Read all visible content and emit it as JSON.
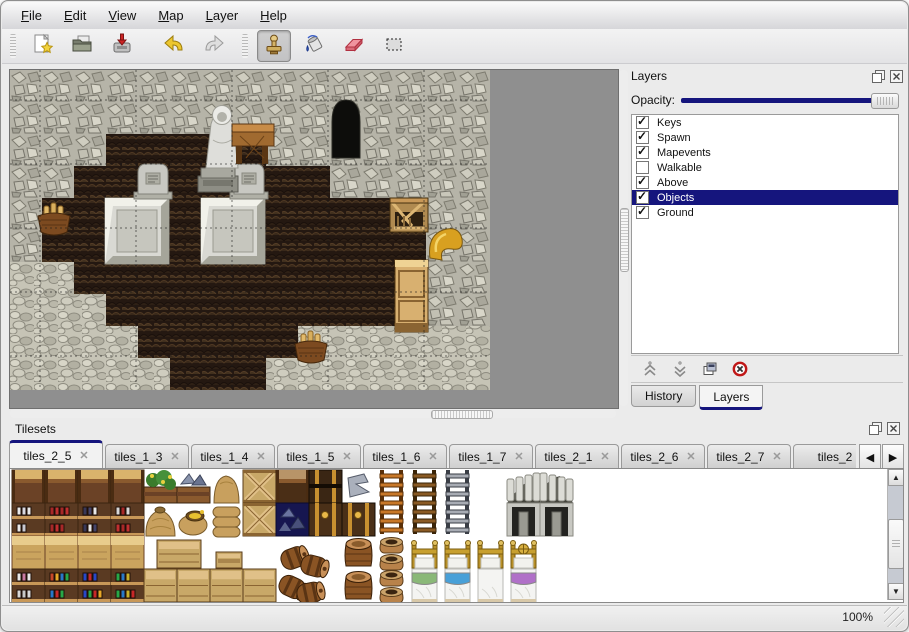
{
  "colors": {
    "accent": "#15157d",
    "selection_text": "#ffffff",
    "map_backdrop": "#8f8f8f"
  },
  "menu": {
    "items": [
      {
        "label": "File"
      },
      {
        "label": "Edit"
      },
      {
        "label": "View"
      },
      {
        "label": "Map"
      },
      {
        "label": "Layer"
      },
      {
        "label": "Help"
      }
    ]
  },
  "toolbar": {
    "buttons": [
      {
        "name": "new"
      },
      {
        "name": "open"
      },
      {
        "name": "save"
      },
      {
        "name": "undo"
      },
      {
        "name": "redo"
      },
      {
        "name": "stamp",
        "active": true
      },
      {
        "name": "fill"
      },
      {
        "name": "eraser"
      },
      {
        "name": "select"
      }
    ],
    "active_tool": "stamp"
  },
  "map": {
    "objects": [
      "stone-cave-wall",
      "dark-scale-floor",
      "pebble-floor",
      "hooded-statue",
      "wooden-table",
      "gravestone-left",
      "gravestone-right",
      "marble-platform-left",
      "marble-platform-right",
      "cave-entrance",
      "basket-left",
      "basket-bottom",
      "broken-crate",
      "wooden-cabinet",
      "golden-horn"
    ]
  },
  "layers_panel": {
    "title": "Layers",
    "opacity_label": "Opacity:",
    "opacity_percent": 100,
    "layers": [
      {
        "label": "Keys",
        "checked": true,
        "selected": false
      },
      {
        "label": "Spawn",
        "checked": true,
        "selected": false
      },
      {
        "label": "Mapevents",
        "checked": true,
        "selected": false
      },
      {
        "label": "Walkable",
        "checked": false,
        "selected": false
      },
      {
        "label": "Above",
        "checked": true,
        "selected": false
      },
      {
        "label": "Objects",
        "checked": true,
        "selected": true
      },
      {
        "label": "Ground",
        "checked": true,
        "selected": false
      }
    ],
    "buttons": [
      {
        "name": "raise-layer"
      },
      {
        "name": "lower-layer"
      },
      {
        "name": "duplicate-layer"
      },
      {
        "name": "delete-layer"
      }
    ],
    "tabs": [
      {
        "label": "History",
        "active": false
      },
      {
        "label": "Layers",
        "active": true
      }
    ]
  },
  "tilesets_panel": {
    "title": "Tilesets",
    "tabs": [
      {
        "label": "tiles_2_5",
        "active": true
      },
      {
        "label": "tiles_1_3",
        "active": false
      },
      {
        "label": "tiles_1_4",
        "active": false
      },
      {
        "label": "tiles_1_5",
        "active": false
      },
      {
        "label": "tiles_1_6",
        "active": false
      },
      {
        "label": "tiles_1_7",
        "active": false
      },
      {
        "label": "tiles_2_1",
        "active": false
      },
      {
        "label": "tiles_2_6",
        "active": false
      },
      {
        "label": "tiles_2_7",
        "active": false
      },
      {
        "label": "tiles_2",
        "active": false
      }
    ]
  },
  "statusbar": {
    "zoom_level": "100%"
  }
}
